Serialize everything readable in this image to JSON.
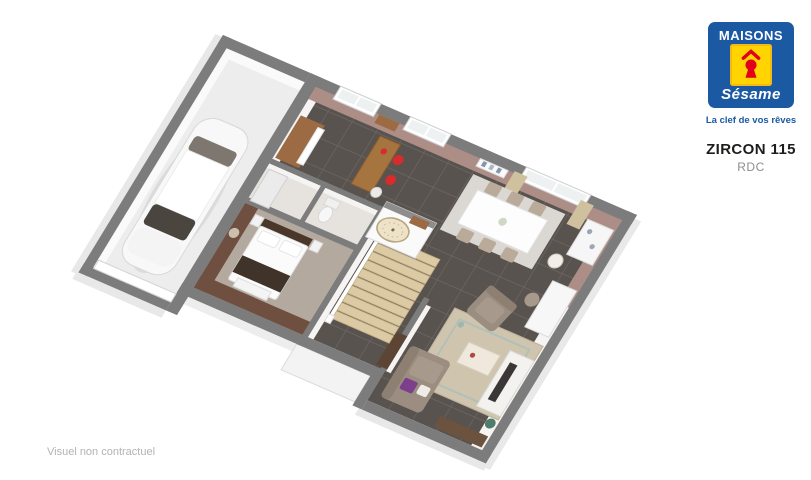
{
  "branding": {
    "name_top": "MAISONS",
    "name_script": "Sésame",
    "tagline": "La clef de vos rêves",
    "colors": {
      "blue": "#1b5aa3",
      "yellow": "#ffd400",
      "red": "#e2001a"
    }
  },
  "plan": {
    "model": "ZIRCON 115",
    "level": "RDC"
  },
  "footer": {
    "disclaimer": "Visuel non contractuel"
  },
  "floorplan": {
    "colors": {
      "wall_gray": "#7c7c7c",
      "wall_face_white": "#f5f4f2",
      "wall_mauve": "#ad8e86",
      "tile_floor": "#59534f",
      "tile_line": "#6e6763",
      "garage_floor": "#ededed",
      "bath_floor": "#e6e3df",
      "bedroom_wall_brown": "#6f5040",
      "bedroom_carpet": "#b4a99e",
      "stair_wood": "#dccaa5",
      "sofa_taupe": "#9b8d80",
      "rug_beige": "#cfc5ae",
      "dining_rug": "#dbd8d3",
      "accent_purple": "#7c3f8c",
      "accent_red": "#d92b2b",
      "wood_cabinet": "#9c6b43",
      "curtain_beige": "#cfc09e",
      "door_brown": "#5c4534"
    }
  }
}
